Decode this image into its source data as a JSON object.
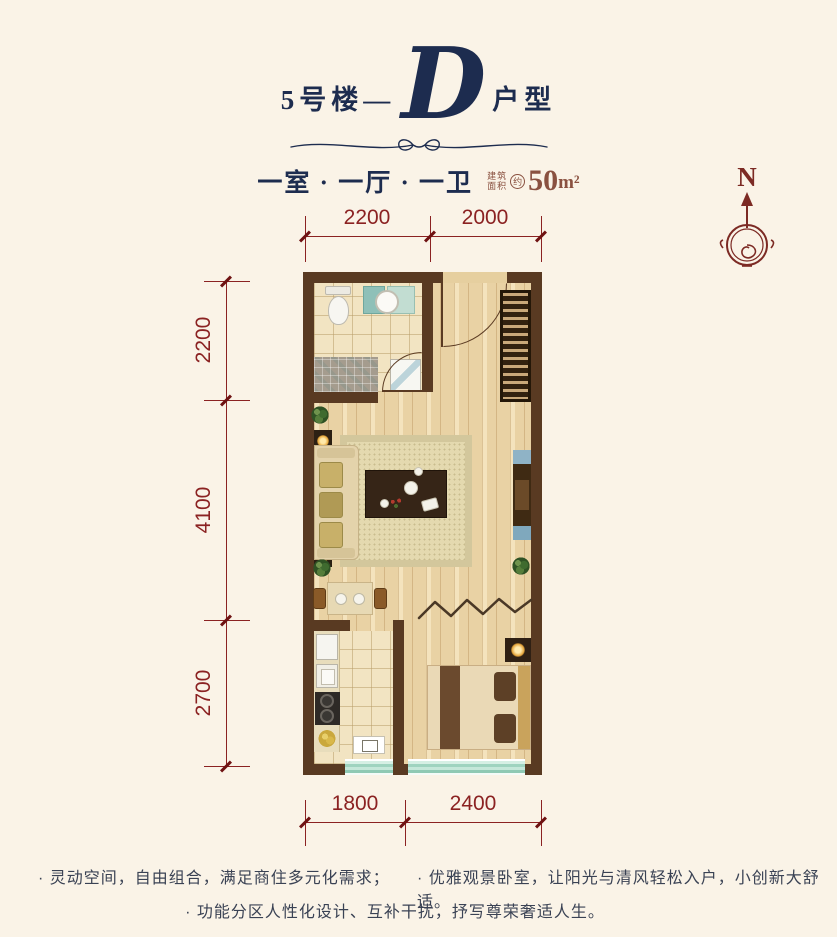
{
  "header": {
    "prefix": "5号楼—",
    "letter": "D",
    "suffix": "户型",
    "rooms": "一室 · 一厅 · 一卫",
    "area_label_top": "建筑",
    "area_label_bottom": "面积",
    "area_approx": "约",
    "area_value": "50",
    "area_unit": "m²"
  },
  "compass": {
    "north": "N"
  },
  "dimensions": {
    "top": [
      "2200",
      "2000"
    ],
    "left": [
      "2200",
      "4100",
      "2700"
    ],
    "bottom": [
      "1800",
      "2400"
    ]
  },
  "features": {
    "left": "· 灵动空间，自由组合，满足商住多元化需求；",
    "right": "· 优雅观景卧室，让阳光与清风轻松入户，小创新大舒适。",
    "center": "· 功能分区人性化设计、互补干扰，抒写尊荣奢适人生。"
  },
  "colors": {
    "background": "#faf3e7",
    "title_navy": "#1d2c4f",
    "dimension_red": "#8b2222",
    "area_maroon": "#8a5140",
    "compass_red": "#7c2a24",
    "wall_brown": "#593a22",
    "window_teal": "#9ed3bf"
  }
}
